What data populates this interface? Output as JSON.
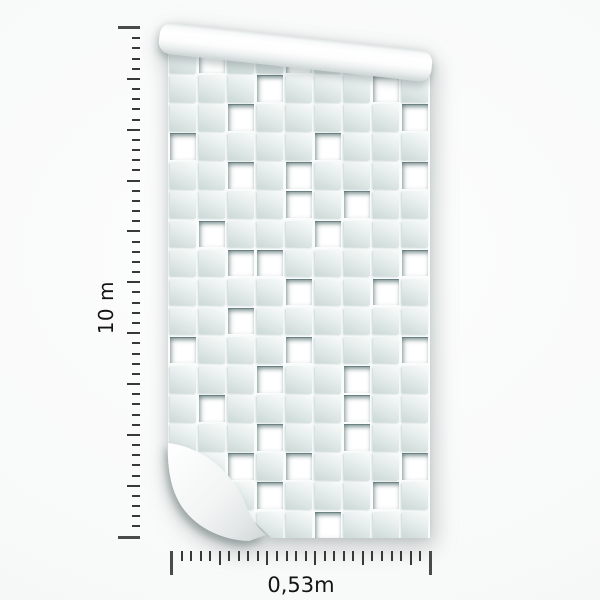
{
  "rulers": {
    "height": {
      "label": "10 m",
      "tick_count": 51,
      "major_every": 5
    },
    "width": {
      "label": "0,53m",
      "tick_count": 28,
      "major_every": 5
    }
  },
  "wallpaper": {
    "columns": 9,
    "rows": 17,
    "pattern_rows": [
      ".W..W....",
      "...W...W.",
      "..W.....W",
      "W....W...",
      "..W.W...W",
      "....W.W..",
      ".W...W...",
      "..WW....W",
      "....W..W.",
      "..W......",
      "W...W...W",
      "...W..W..",
      ".W....W..",
      "...W..W..",
      "..W.W...W",
      "...W...W.",
      ".....W..."
    ],
    "tile_colors": {
      "light": "#f8fbfa",
      "dark": "#ccd9d6",
      "hole": "#ffffff",
      "grout": "#fbfdfd"
    }
  },
  "colors": {
    "tick": "#383838",
    "label": "#141414",
    "background": "#f8f9f9"
  }
}
